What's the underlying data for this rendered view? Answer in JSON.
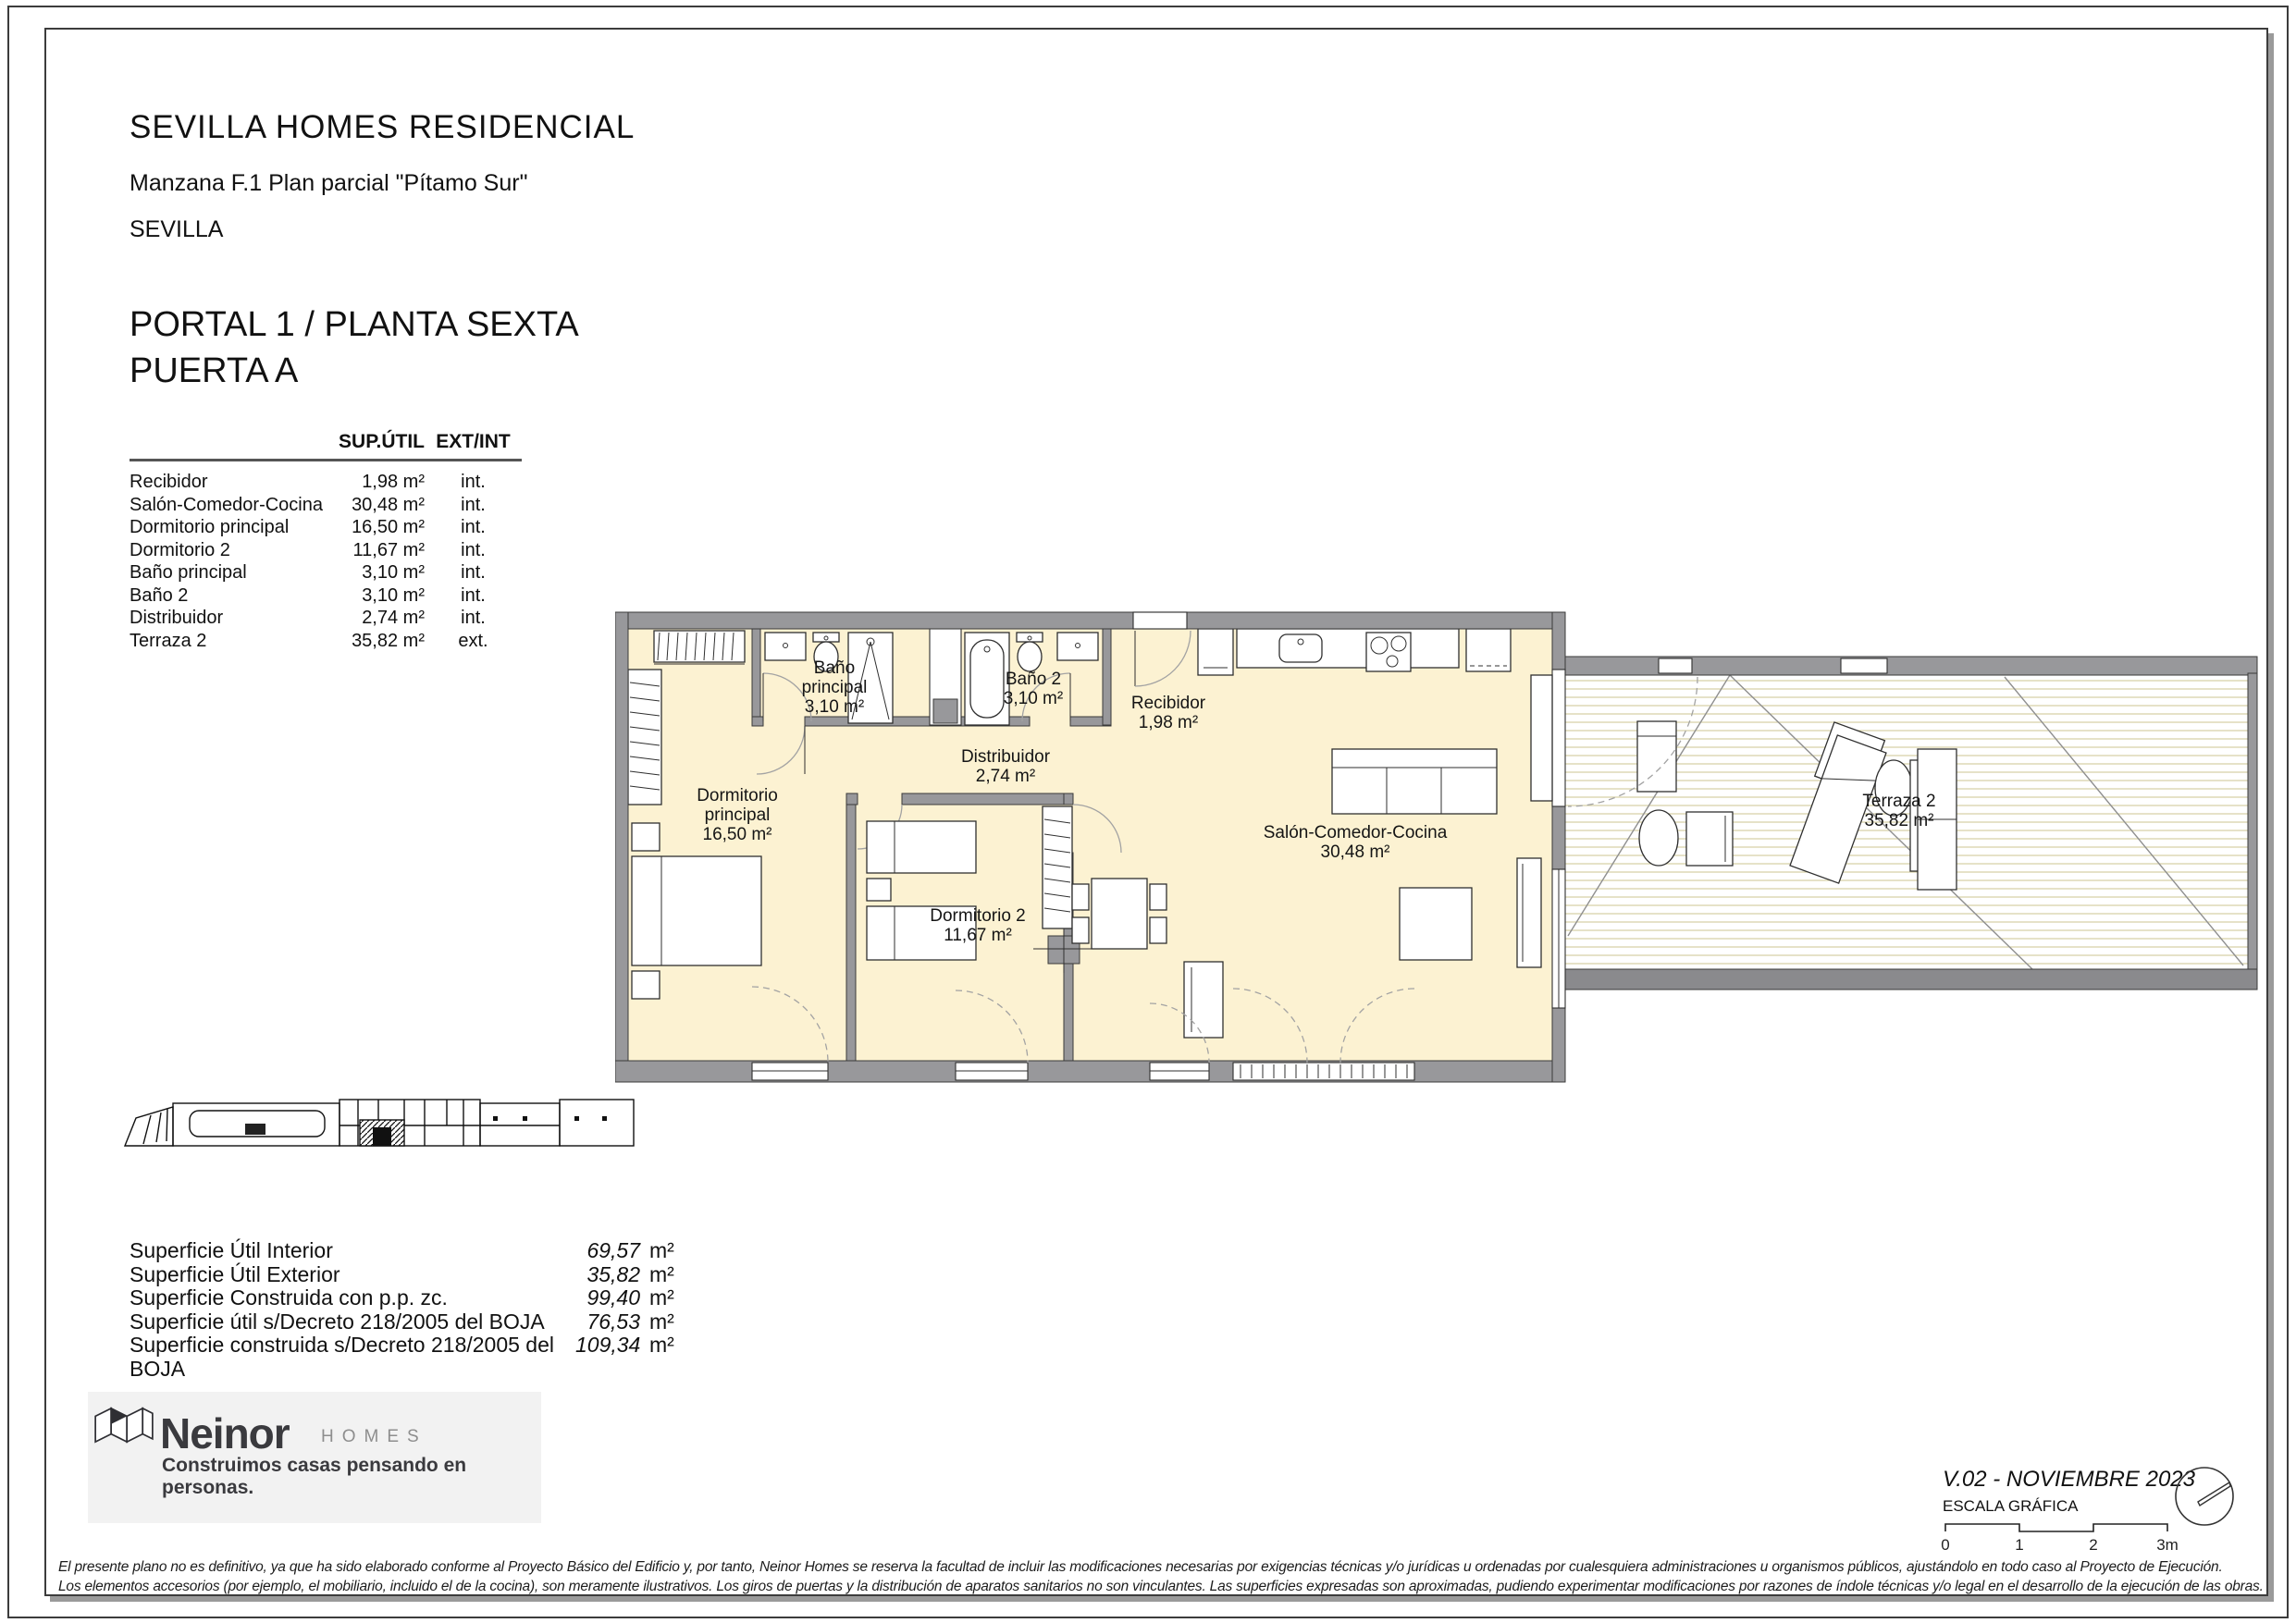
{
  "header": {
    "title": "SEVILLA HOMES RESIDENCIAL",
    "subtitle": "Manzana F.1 Plan parcial \"Pítamo Sur\"",
    "city": "SEVILLA"
  },
  "unit": {
    "title": "PORTAL 1 / PLANTA SEXTA\nPUERTA A"
  },
  "rooms_table": {
    "col_area": "SUP.ÚTIL",
    "col_type": "EXT/INT",
    "rows": [
      {
        "name": "Recibidor",
        "area": "1,98 m²",
        "type": "int."
      },
      {
        "name": "Salón-Comedor-Cocina",
        "area": "30,48 m²",
        "type": "int."
      },
      {
        "name": "Dormitorio principal",
        "area": "16,50 m²",
        "type": "int."
      },
      {
        "name": "Dormitorio 2",
        "area": "11,67 m²",
        "type": "int."
      },
      {
        "name": "Baño principal",
        "area": "3,10 m²",
        "type": "int."
      },
      {
        "name": "Baño 2",
        "area": "3,10 m²",
        "type": "int."
      },
      {
        "name": "Distribuidor",
        "area": "2,74 m²",
        "type": "int."
      },
      {
        "name": "Terraza 2",
        "area": "35,82 m²",
        "type": "ext."
      }
    ]
  },
  "plan": {
    "bano_ppal": {
      "l1": "Baño",
      "l2": "principal",
      "l3": "3,10 m²"
    },
    "bano2": {
      "l1": "Baño 2",
      "l2": "3,10 m²"
    },
    "recibidor": {
      "l1": "Recibidor",
      "l2": "1,98 m²"
    },
    "distribuidor": {
      "l1": "Distribuidor",
      "l2": "2,74 m²"
    },
    "dorm_ppal": {
      "l1": "Dormitorio",
      "l2": "principal",
      "l3": "16,50 m²"
    },
    "dorm2": {
      "l1": "Dormitorio 2",
      "l2": "11,67 m²"
    },
    "salon": {
      "l1": "Salón-Comedor-Cocina",
      "l2": "30,48 m²"
    },
    "terraza": {
      "l1": "Terraza 2",
      "l2": "35,82 m²"
    }
  },
  "summary": {
    "unit": "m²",
    "rows": [
      {
        "label": "Superficie Útil Interior",
        "value": "69,57"
      },
      {
        "label": "Superficie Útil Exterior",
        "value": "35,82"
      },
      {
        "label": "Superficie Construida con p.p. zc.",
        "value": "99,40"
      },
      {
        "label": "Superficie útil s/Decreto 218/2005 del BOJA",
        "value": "76,53"
      },
      {
        "label": "Superficie construida s/Decreto 218/2005 del BOJA",
        "value": "109,34"
      }
    ]
  },
  "brand": {
    "name": "Neinor",
    "sub": "HOMES",
    "tagline": "Construimos casas pensando en personas."
  },
  "meta": {
    "version": "V.02 - NOVIEMBRE 2023",
    "scale_label": "ESCALA GRÁFICA",
    "scale_ticks": [
      "0",
      "1",
      "2",
      "3m"
    ]
  },
  "disclaimer": {
    "line1": "El presente plano no es definitivo, ya que ha sido elaborado conforme al Proyecto Básico del Edificio y, por tanto, Neinor Homes se reserva la facultad de incluir las modificaciones necesarias por exigencias técnicas y/o jurídicas u ordenadas por cualesquiera administraciones u organismos públicos, ajustándolo en todo caso al Proyecto de Ejecución.",
    "line2": "Los elementos accesorios (por ejemplo, el mobiliario, incluido el de la cocina), son meramente ilustrativos. Los giros de puertas y la distribución de aparatos sanitarios no son vinculantes. Las superficies expresadas son aproximadas, pudiendo experimentar modificaciones por razones de índole técnicas y/o legal en el desarrollo de la ejecución de las obras."
  },
  "colors": {
    "wall": "#98989b",
    "wall_dark": "#8a8a8d",
    "room_cream": "#fcf2d2",
    "deck_line": "#d6d0a4"
  }
}
